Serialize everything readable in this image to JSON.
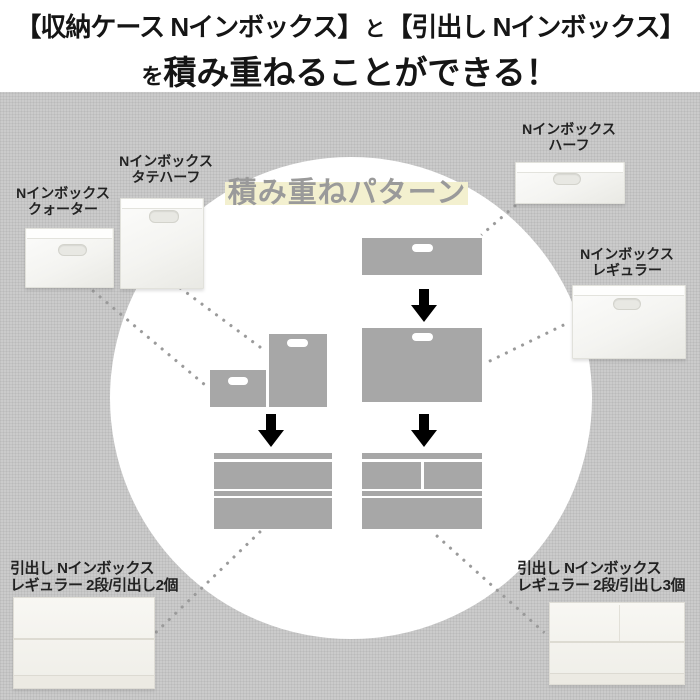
{
  "header": {
    "line1_left": "【収納ケース Nインボックス】",
    "line1_connector": "と",
    "line1_right": "【引出し Nインボックス】",
    "line2_prefix": "を",
    "line2_main": "積み重ねることができる！"
  },
  "pattern_title": "積み重ねパターン",
  "products": {
    "quarter": {
      "line1": "Nインボックス",
      "line2": "クォーター"
    },
    "tatehalf": {
      "line1": "Nインボックス",
      "line2": "タテハーフ"
    },
    "half": {
      "line1": "Nインボックス",
      "line2": "ハーフ"
    },
    "regular": {
      "line1": "Nインボックス",
      "line2": "レギュラー"
    },
    "drawer2": {
      "line1": "引出し Nインボックス",
      "line2": "レギュラー 2段/引出し2個"
    },
    "drawer3": {
      "line1": "引出し Nインボックス",
      "line2": "レギュラー 2段/引出し3個"
    }
  },
  "colors": {
    "background_gray": "#cbcbcb",
    "header_background": "#ffffff",
    "header_text": "#151515",
    "circle_white": "#ffffff",
    "diagram_gray": "#a7a7a7",
    "arrow_black": "#000000",
    "dot_gray": "#9a9a9a",
    "title_text_gray": "#9a9a9a",
    "title_highlight_yellow": "#f3f0cf",
    "label_text": "#222222",
    "photo_white": "#f6f6f3"
  }
}
